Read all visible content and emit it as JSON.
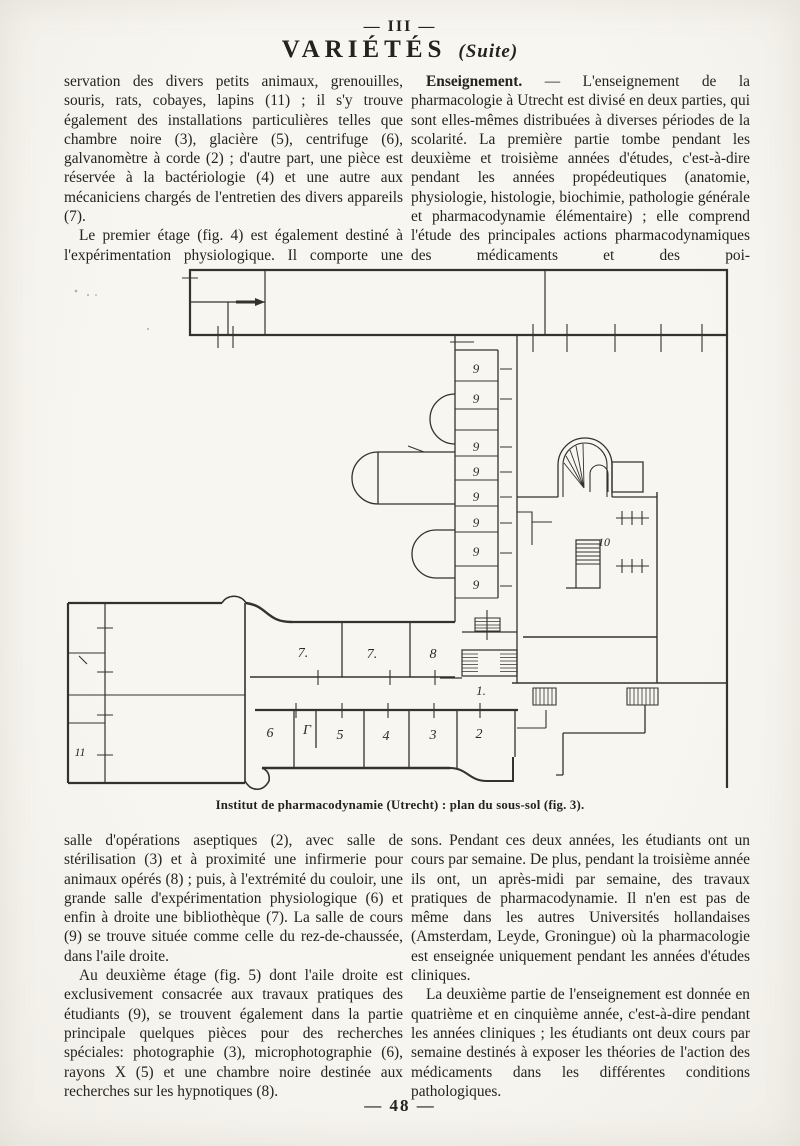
{
  "page": {
    "header_number": "— III —",
    "title": "VARIÉTÉS",
    "subtitle": "(Suite)",
    "footer_number": "— 48 —"
  },
  "text": {
    "left_top_p1": "servation des divers petits animaux, grenouilles, souris, rats, cobayes, lapins (11) ; il s'y trouve également des installations particulières telles que chambre noire (3), glacière (5), centrifuge (6), galvanomètre à corde (2) ; d'autre part, une pièce est réservée à la bactériologie (4) et une autre aux mécaniciens chargés de l'entretien des divers appareils (7).",
    "left_top_p2": "Le premier étage (fig. 4) est également destiné à l'expérimentation physiologique. Il comporte une",
    "right_top_lead": "Enseignement.",
    "right_top_p1": " — L'enseignement de la pharmacologie à Utrecht est divisé en deux parties, qui sont elles-mêmes distribuées à diverses périodes de la scolarité. La première partie tombe pendant les deuxième et troisième années d'études, c'est-à-dire pendant les années propédeutiques (anatomie, physiologie, histologie, biochimie, pathologie générale et pharmacodynamie élémentaire) ; elle comprend l'étude des principales actions pharmacodynamiques des médicaments et des poi-",
    "left_bottom_p1": "salle d'opérations aseptiques (2), avec salle de stérilisation (3) et à proximité une infirmerie pour animaux opérés (8) ; puis, à l'extrémité du couloir, une grande salle d'expérimentation physiologique (6) et enfin à droite une bibliothèque (7). La salle de cours (9) se trouve située comme celle du rez-de-chaussée, dans l'aile droite.",
    "left_bottom_p2": "Au deuxième étage (fig. 5) dont l'aile droite est exclusivement consacrée aux travaux pratiques des étudiants (9), se trouvent également dans la partie principale quelques pièces pour des recherches spéciales: photographie (3), microphotographie (6), rayons X (5) et une chambre noire destinée aux recherches sur les hypnotiques (8).",
    "right_bottom_p1": "sons. Pendant ces deux années, les étudiants ont un cours par semaine. De plus, pendant la troisième année ils ont, un après-midi par semaine, des travaux pratiques de pharmacodynamie. Il n'en est pas de même dans les autres Universités hollandaises (Amsterdam, Leyde, Groningue) où la pharmacologie est enseignée uniquement pendant les années d'études cliniques.",
    "right_bottom_p2": "La deuxième partie de l'enseignement est donnée en quatrième et en cinquième année, c'est-à-dire pendant les années cliniques ; les étudiants ont deux cours par semaine destinés à exposer les théories de l'action des médicaments dans les différentes conditions pathologiques."
  },
  "figure": {
    "caption": "Institut de pharmacodynamie (Utrecht) : plan du sous-sol (fig. 3).",
    "labels": [
      "9",
      "9",
      "9",
      "9",
      "9",
      "9",
      "9",
      "9",
      "10",
      "7.",
      "7.",
      "8",
      "1.",
      "6",
      "Γ",
      "5",
      "4",
      "3",
      "2",
      "11"
    ]
  },
  "colors": {
    "paper": "#f6f4ee",
    "ink": "#26231f",
    "plan_line": "#35322d"
  }
}
